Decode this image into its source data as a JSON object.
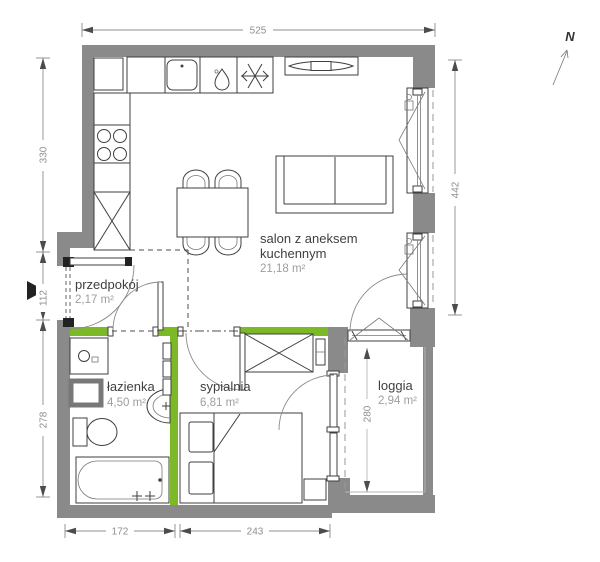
{
  "north": {
    "label": "N"
  },
  "rooms": {
    "salon": {
      "name_line1": "salon z aneksem",
      "name_line2": "kuchennym",
      "area": "21,18 m²"
    },
    "przedpokoj": {
      "name": "przedpokój",
      "area": "2,17 m²"
    },
    "lazienka": {
      "name": "łazienka",
      "area": "4,50 m²"
    },
    "sypialnia": {
      "name": "sypialnia",
      "area": "6,81 m²"
    },
    "loggia": {
      "name": "loggia",
      "area": "2,94 m²"
    }
  },
  "dimensions": {
    "top": "525",
    "left_upper": "330",
    "left_middle": "112",
    "left_lower": "278",
    "right": "442",
    "loggia_height": "280",
    "bottom_left": "172",
    "bottom_right": "243"
  },
  "colors": {
    "wall": "#8a8a8a",
    "accent_green": "#7cb927",
    "line": "#3f3f3f",
    "dim": "#8f8f8f",
    "room_name": "#3f3f3f",
    "room_area": "#9e9e9e"
  }
}
